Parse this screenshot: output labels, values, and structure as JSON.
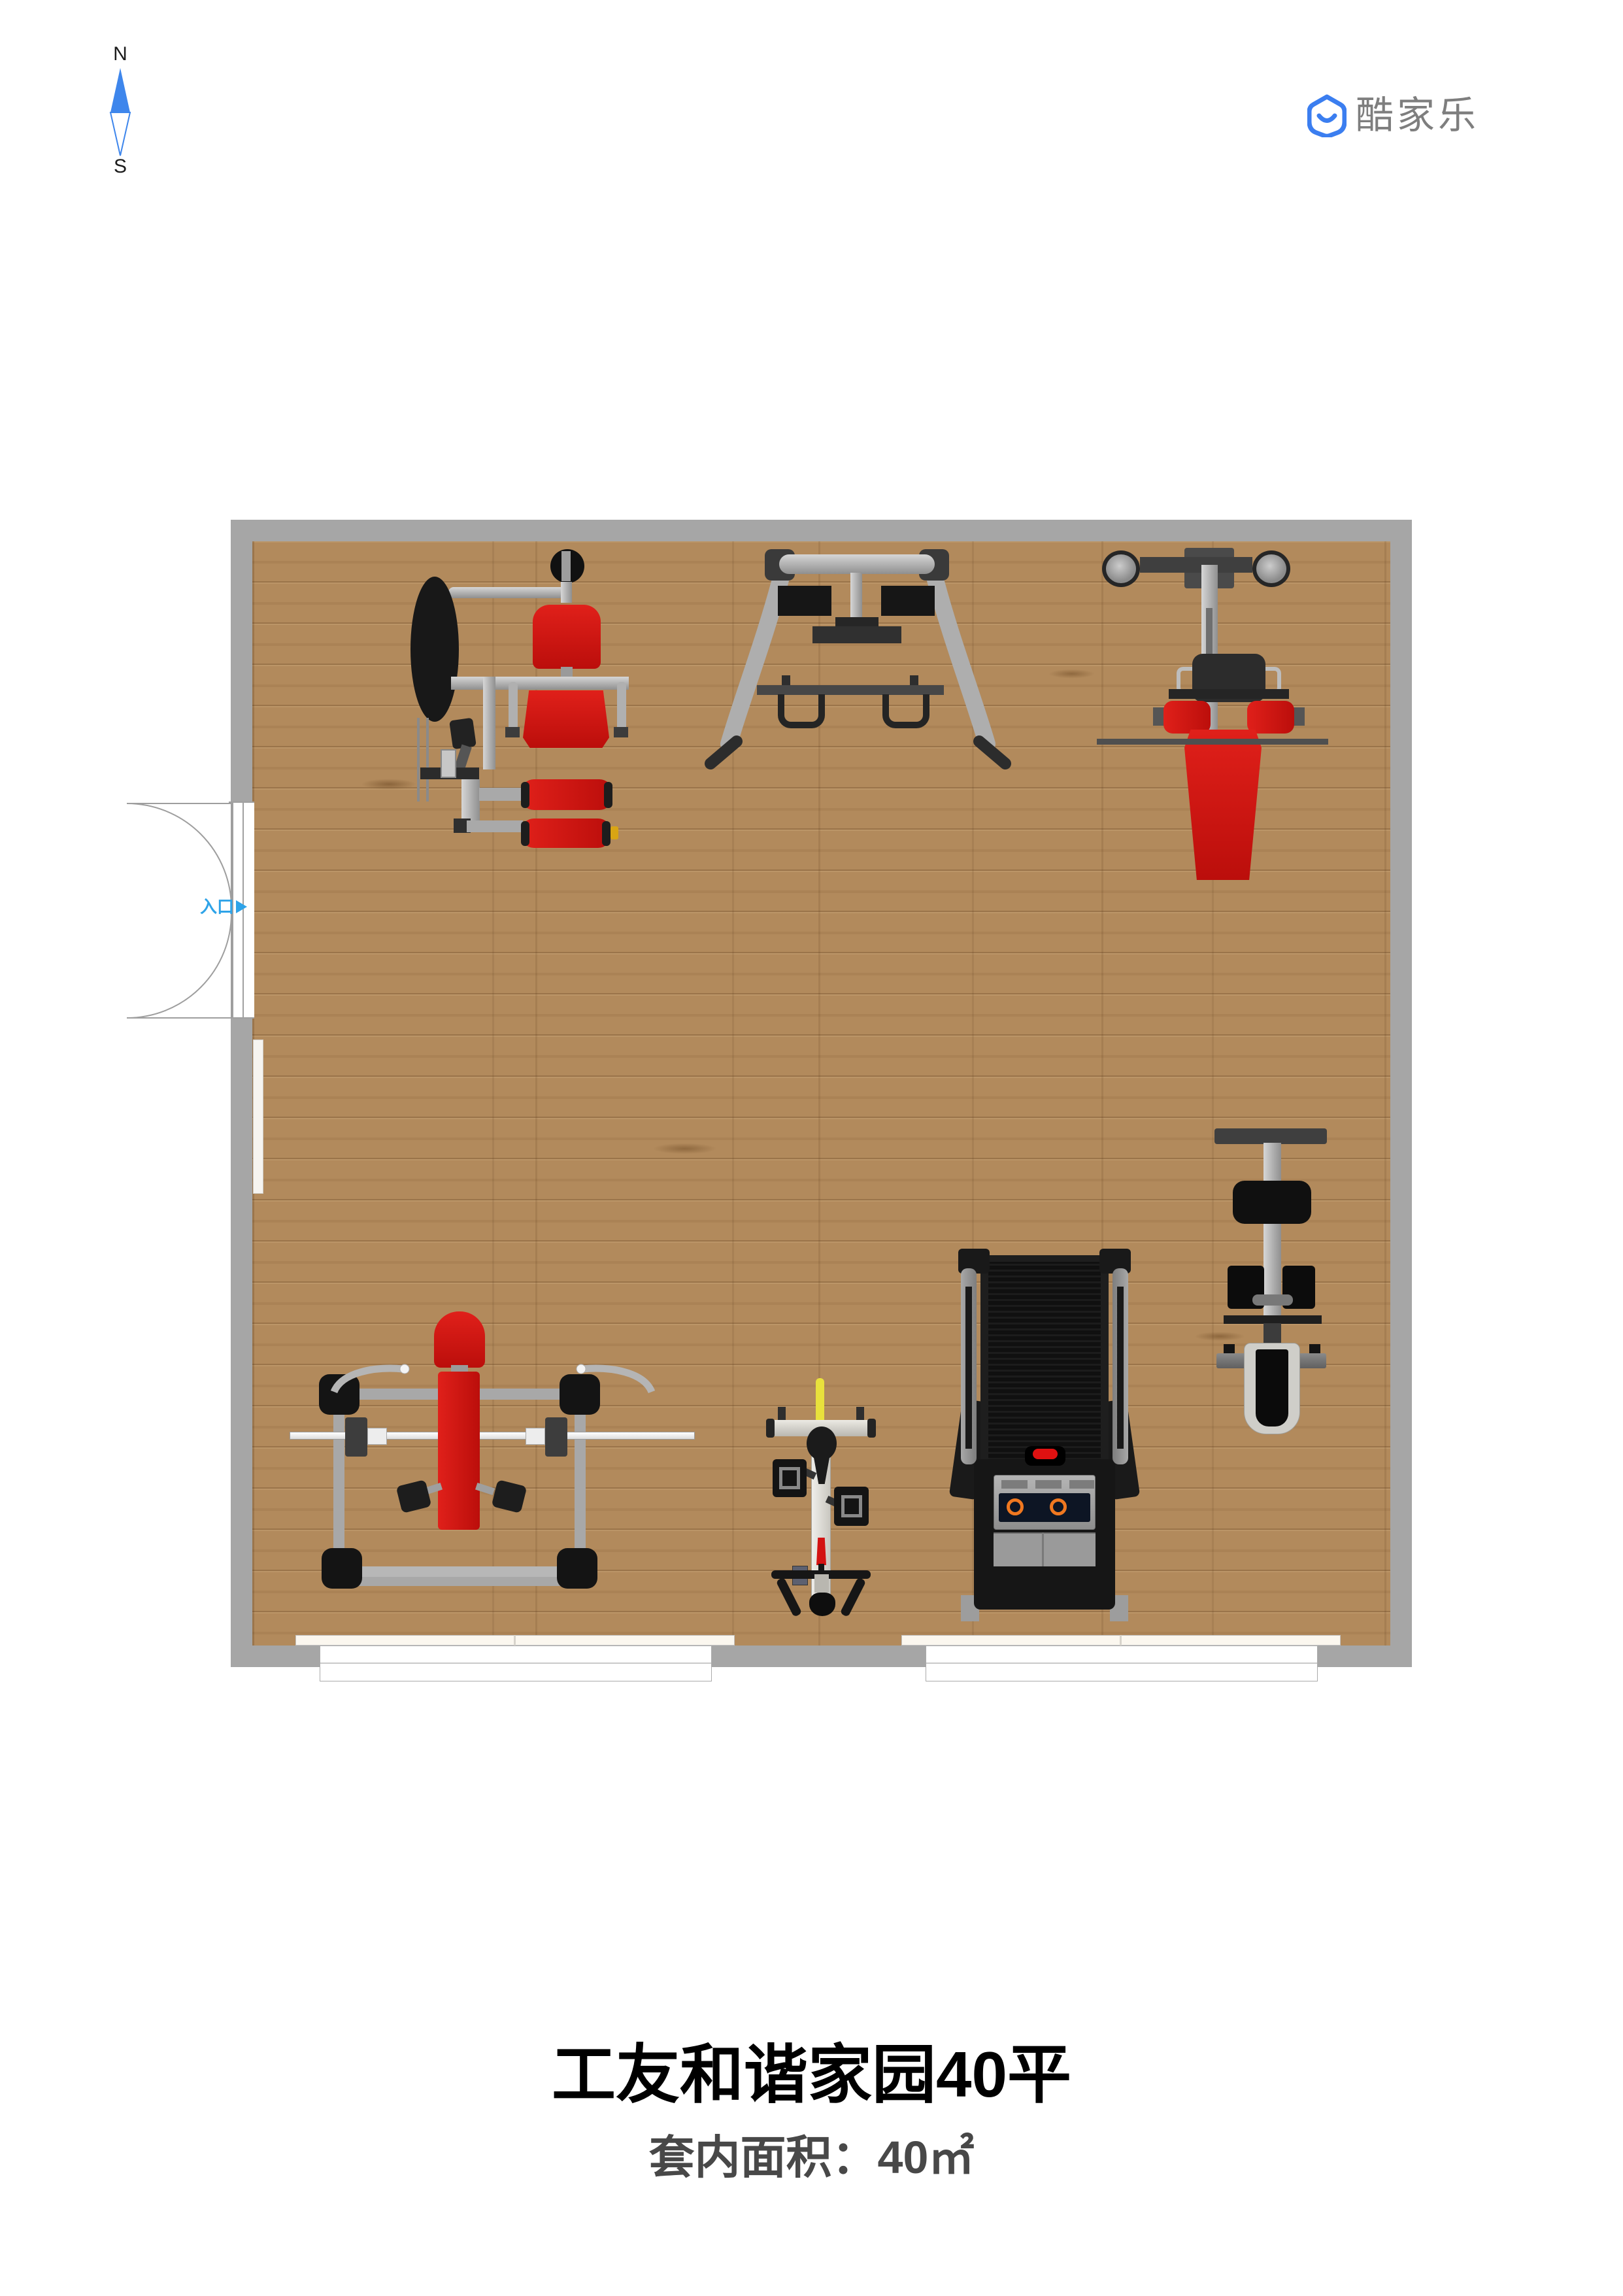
{
  "compass": {
    "north": "N",
    "south": "S",
    "needle_color": "#3e86ec"
  },
  "logo": {
    "brand": "酷家乐",
    "icon_color": "#3b7ef0",
    "text_color": "#7e7e7e"
  },
  "floorplan": {
    "entrance_label": "入口",
    "entrance_color": "#2ea3e8",
    "wall_color": "#a6a6a6",
    "floor_color": "#b28a5c",
    "accent_red": "#cf1313",
    "equipment": [
      {
        "name": "multi-station home gym"
      },
      {
        "name": "a-frame power rack"
      },
      {
        "name": "lat pulldown machine"
      },
      {
        "name": "bench press station"
      },
      {
        "name": "exercise bike"
      },
      {
        "name": "treadmill"
      },
      {
        "name": "abdominal bench machine"
      }
    ]
  },
  "footer": {
    "title": "工友和谐家园40平",
    "subtitle": "套内面积：40㎡"
  }
}
